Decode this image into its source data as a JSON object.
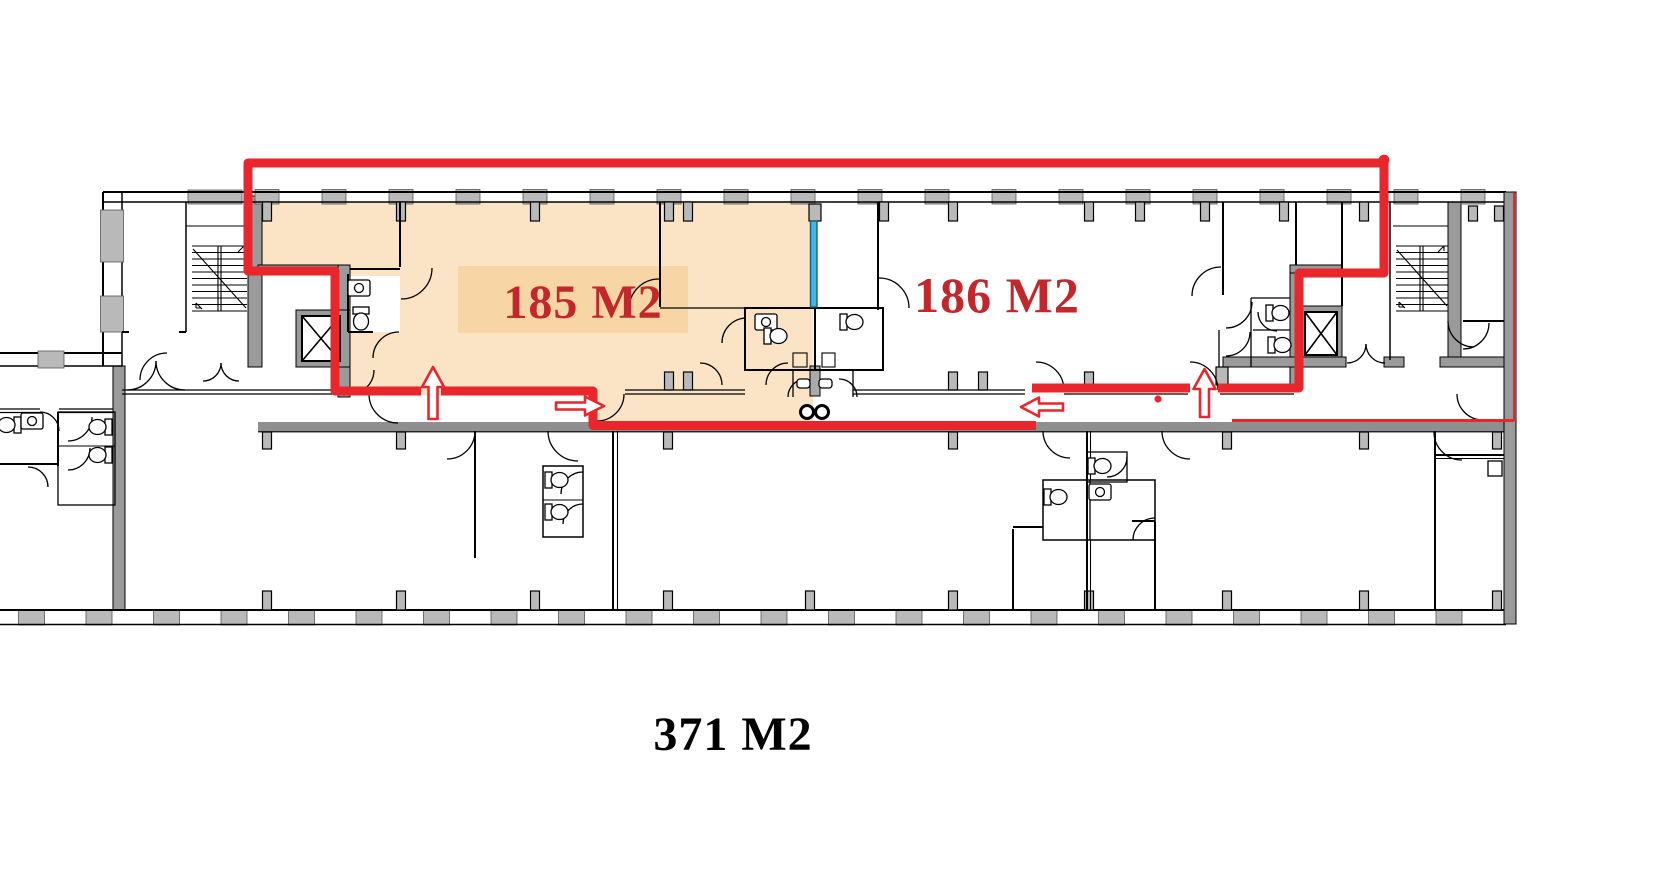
{
  "page": {
    "type": "architectural floor plan with lease area annotation",
    "background": "#ffffff"
  },
  "labels": {
    "area_a": "185 M2",
    "area_b": "186 M2",
    "area_total": "371 M2"
  },
  "colors": {
    "annotation_red": "#e9262b",
    "area_label_red": "#c2272c",
    "total_label_black": "#000000",
    "highlight_fill": "#fbe3c6",
    "highlight_label_box": "#f7d5a4",
    "proposed_wall_blue": "#41b7e8",
    "wall_gray": "#9a9a9a",
    "window_sill_gray": "#b9b9b9",
    "corridor_wall_gray": "#8f8f8f"
  },
  "annotations": {
    "boundary_description": "red outline tracing leased suites",
    "arrows": [
      {
        "name": "entrance-arrow-up-left",
        "direction": "up"
      },
      {
        "name": "entrance-arrow-right",
        "direction": "right"
      },
      {
        "name": "entrance-arrow-left",
        "direction": "left"
      },
      {
        "name": "entrance-arrow-up-right",
        "direction": "up"
      }
    ],
    "marker_dot": {
      "shape": "small red dot"
    },
    "proposed_partition": {
      "style": "blue line"
    }
  }
}
